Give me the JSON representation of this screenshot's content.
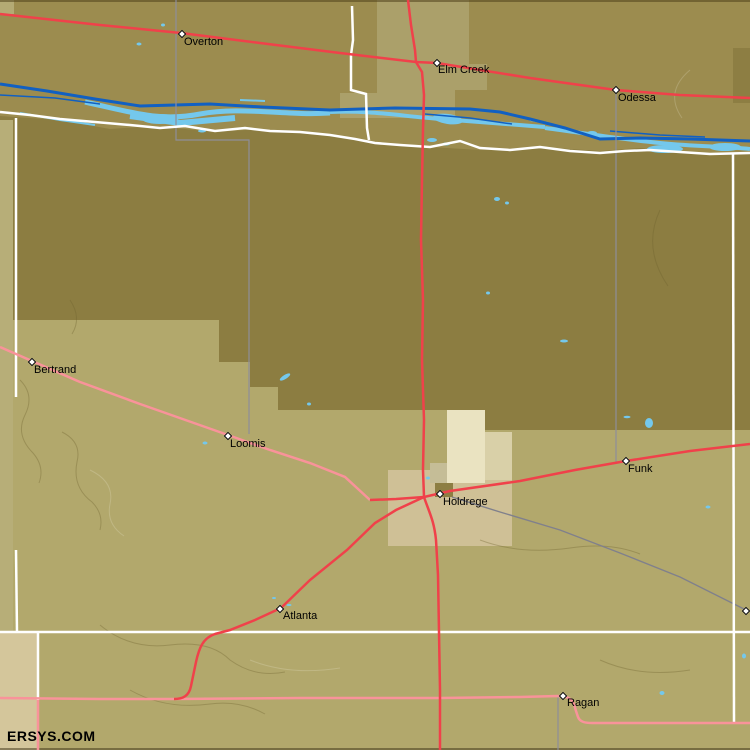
{
  "map": {
    "source_label": "ERSYS.COM",
    "towns": [
      {
        "name": "Overton",
        "x": 182,
        "y": 34,
        "label_x": 184,
        "label_y": 37
      },
      {
        "name": "Elm Creek",
        "x": 437,
        "y": 63,
        "label_x": 438,
        "label_y": 65
      },
      {
        "name": "Odessa",
        "x": 616,
        "y": 90,
        "label_x": 618,
        "label_y": 93
      },
      {
        "name": "Bertrand",
        "x": 32,
        "y": 362,
        "label_x": 34,
        "label_y": 365
      },
      {
        "name": "Loomis",
        "x": 228,
        "y": 436,
        "label_x": 230,
        "label_y": 439
      },
      {
        "name": "Funk",
        "x": 626,
        "y": 461,
        "label_x": 628,
        "label_y": 464
      },
      {
        "name": "Holdrege",
        "x": 440,
        "y": 494,
        "label_x": 443,
        "label_y": 497
      },
      {
        "name": "Atlanta",
        "x": 280,
        "y": 609,
        "label_x": 283,
        "label_y": 611
      },
      {
        "name": "Ragan",
        "x": 563,
        "y": 696,
        "label_x": 567,
        "label_y": 698
      }
    ],
    "unlabeled_markers": [
      {
        "x": 746,
        "y": 611
      }
    ],
    "colors": {
      "terrain_north_olive": "#9c8c4f",
      "terrain_dark_band": "#8c7d41",
      "terrain_south_khaki": "#b2a86c",
      "terrain_light_patch": "#aba06a",
      "terrain_city_cream": "#eae3c1",
      "terrain_city_beige": "#cfc096",
      "river_dark_blue": "#1160c2",
      "river_braid_blue": "#74c8ec",
      "highway_red": "#f0414a",
      "road_pink": "#f9939a",
      "road_white": "#ffffff",
      "county_line_gray": "#8e8e9a",
      "railroad_gray": "#80808c"
    }
  }
}
